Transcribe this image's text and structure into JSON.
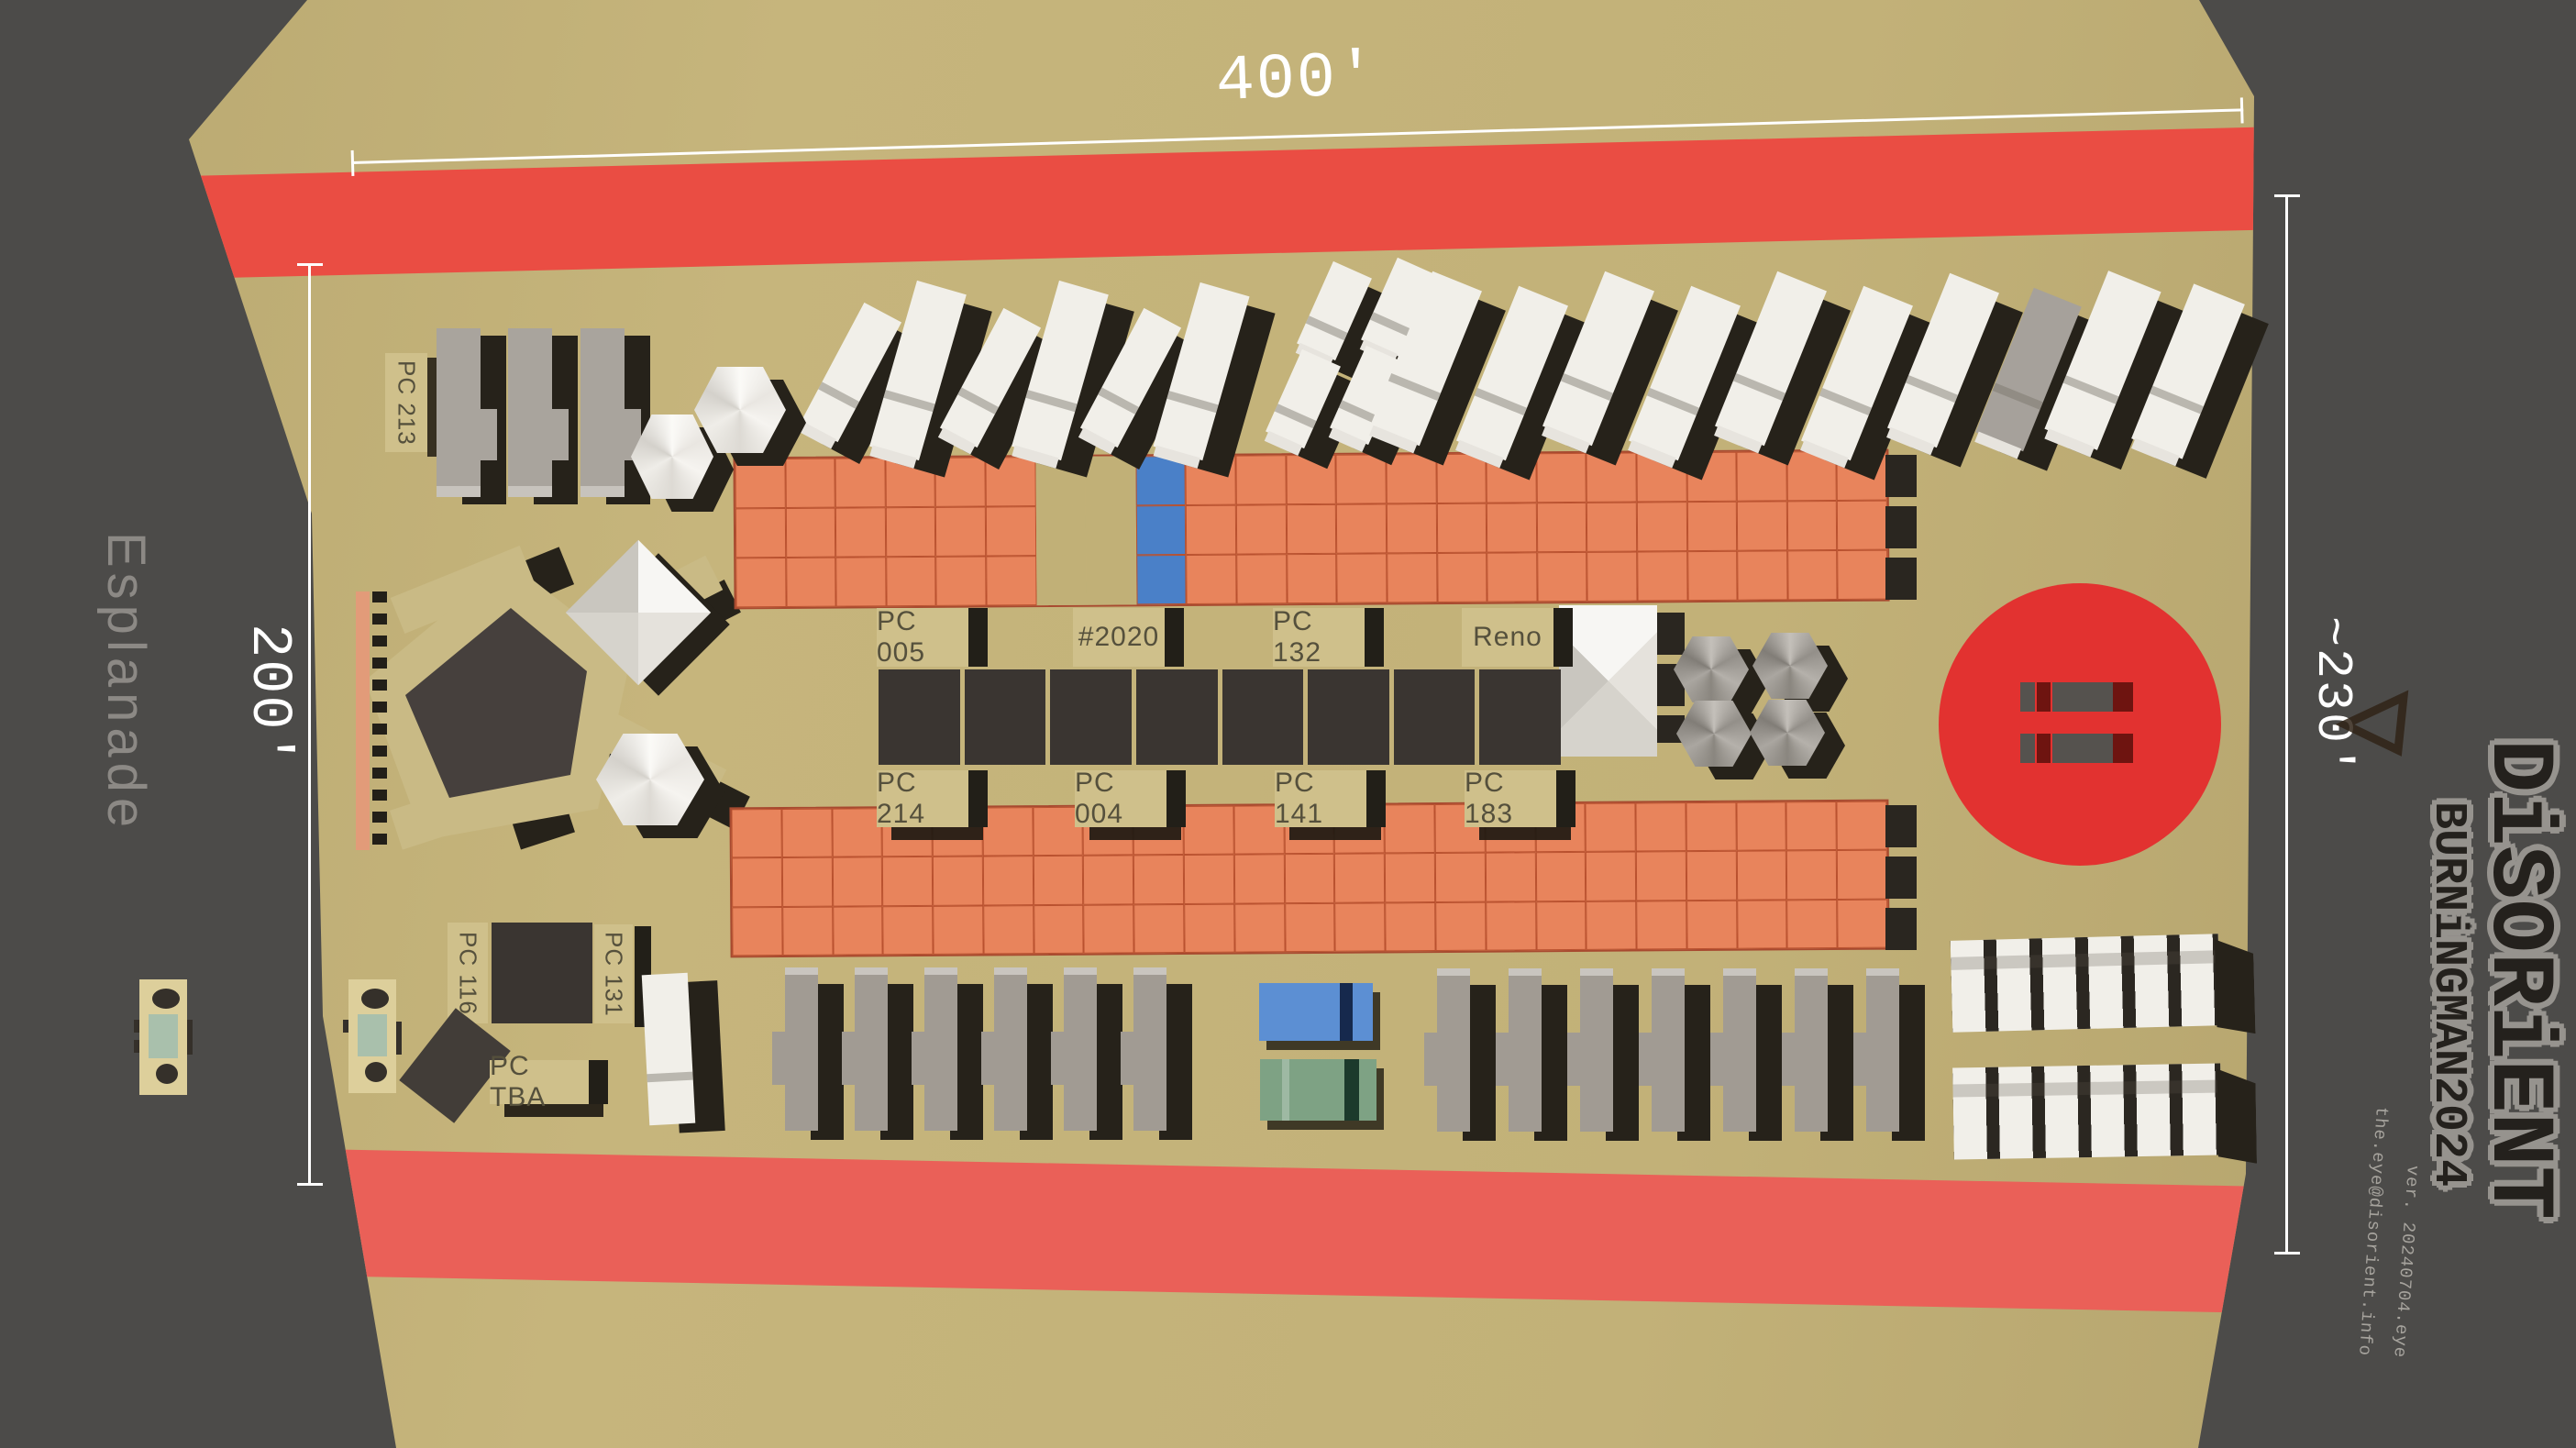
{
  "dimensions": {
    "top": "400'",
    "left": "200'",
    "right": "~230'"
  },
  "street": "Esplanade",
  "labels": {
    "pc213": "PC 213",
    "center_top": [
      "PC 005",
      "#2020",
      "PC 132",
      "Reno"
    ],
    "center_bottom": [
      "PC 214",
      "PC 004",
      "PC 141",
      "PC 183"
    ],
    "pc116": "PC 116",
    "pc131": "PC 131",
    "pctba": "PC TBA"
  },
  "logo": {
    "main": "DiSORiENT",
    "sub": "BURNiNGMAN2024",
    "version": "ver. 20240704.eye",
    "email": "the.eye@disorient.info"
  },
  "colors": {
    "playa": "#c1b077",
    "border": "#4c4b49",
    "road": "#ea4d43",
    "road_bottom": "#ea6058",
    "circle": "#e23230",
    "grid": "#e8845c",
    "grid_line": "#b9512f",
    "cell_blue": "#4a80c8",
    "container": "#3a3531",
    "plaque": "#cfc08b",
    "plaque_text": "#55503c",
    "shadow": "#26221a",
    "rv_white": "#f1efe9",
    "rv_gray": "#a19b93",
    "bus_blue": "#5c8fd3",
    "bus_green": "#7ea284",
    "bus_blue_stripe": "#16294d",
    "bus_green_stripe": "#1c3a2c",
    "strip_salmon": "#e29b79",
    "maroon": "#6e1410",
    "logo_dark": "#24211d",
    "logo_glow": "#96938e",
    "gray_text": "#8c8985",
    "mini_teal": "#a9c0ac"
  }
}
